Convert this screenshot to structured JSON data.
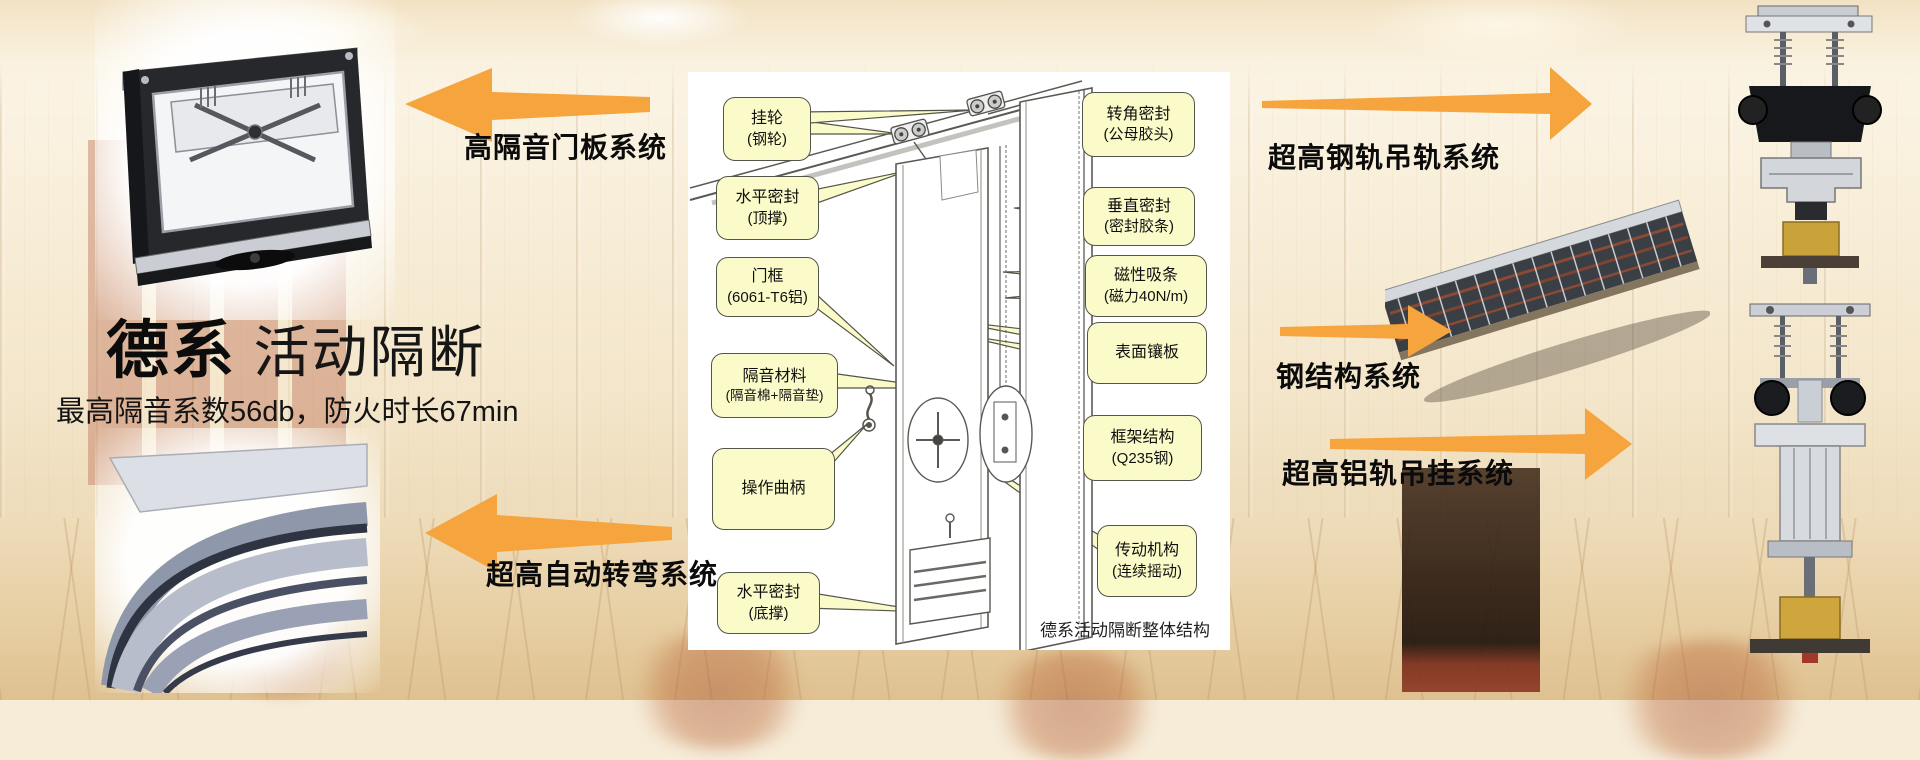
{
  "header": {
    "title_bold": "德系",
    "title_light": " 活动隔断",
    "subtitle": "最高隔音系数56db，防火时长67min"
  },
  "systems": {
    "door_panel": "高隔音门板系统",
    "auto_turn": "超高自动转弯系统",
    "steel_rail": "超高钢轨吊轨系统",
    "steel_structure": "钢结构系统",
    "alu_rail": "超高铝轨吊挂系统"
  },
  "diagram": {
    "caption": "德系活动隔断整体结构",
    "callouts_left": [
      {
        "line1": "挂轮",
        "line2": "(钢轮)"
      },
      {
        "line1": "水平密封",
        "line2": "(顶撑)"
      },
      {
        "line1": "门框",
        "line2": "(6061-T6铝)"
      },
      {
        "line1": "隔音材料",
        "line2": "(隔音棉+隔音垫)"
      },
      {
        "line1": "操作曲柄",
        "line2": ""
      },
      {
        "line1": "水平密封",
        "line2": "(底撑)"
      }
    ],
    "callouts_right": [
      {
        "line1": "转角密封",
        "line2": "(公母胶头)"
      },
      {
        "line1": "垂直密封",
        "line2": "(密封胶条)"
      },
      {
        "line1": "磁性吸条",
        "line2": "(磁力40N/m)"
      },
      {
        "line1": "表面镶板",
        "line2": ""
      },
      {
        "line1": "框架结构",
        "line2": "(Q235钢)"
      },
      {
        "line1": "传动机构",
        "line2": "(连续摇动)"
      }
    ]
  },
  "photos": {
    "top_left": "door-panel-cross-section-photo",
    "bottom_left": "curved-track-photo",
    "right_middle": "steel-structure-photo",
    "far_right_top": "steel-rail-hanger-photo",
    "far_right_bottom": "aluminium-rail-hanger-photo"
  },
  "colors": {
    "arrow_orange": "#F6A43E",
    "callout_bg": "#FBFBC9",
    "callout_border": "#54554A",
    "panel_bg": "#FFFFFF"
  }
}
